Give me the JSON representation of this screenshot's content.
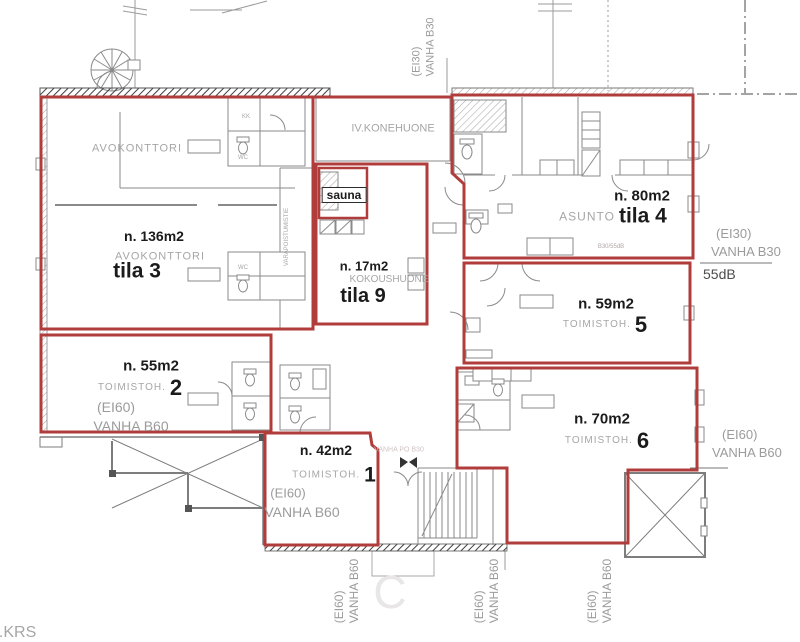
{
  "floor_label": "2.KRS",
  "colors": {
    "compartment_red": "#b13c3c",
    "wall_gray": "#8a8a8a",
    "label_gray": "#a6a6a6",
    "label_dark": "#1b1b1b"
  },
  "rooms": {
    "tila3": {
      "zone_label": "AVOKONTTORI",
      "area": "n. 136m2",
      "type": "AVOKONTTORI",
      "name": "tila 3"
    },
    "tila9": {
      "area": "n. 17m2",
      "type": "KOKOUSHUONE",
      "name": "tila 9"
    },
    "tila4": {
      "area": "n. 80m2",
      "type": "ASUNTO",
      "name": "tila 4",
      "note": "B30/55dB"
    },
    "tila5": {
      "area": "n. 59m2",
      "type": "TOIMISTOH.",
      "number": "5"
    },
    "tila2": {
      "area": "n. 55m2",
      "type": "TOIMISTOH.",
      "number": "2",
      "rating1": "(EI60)",
      "rating2": "VANHA B60"
    },
    "tila1": {
      "area": "n. 42m2",
      "type": "TOIMISTOH.",
      "number": "1",
      "rating1": "(EI60)",
      "rating2": "VANHA B60"
    },
    "tila6": {
      "area": "n. 70m2",
      "type": "TOIMISTOH.",
      "number": "6"
    },
    "sauna": {
      "name": "sauna"
    },
    "iv_room": {
      "name": "IV.KONEHUONE"
    }
  },
  "small_labels": {
    "kk": "KK",
    "wc": "WC",
    "varapoistumistie": "VARAPOISTUMISTIE",
    "vanha_po_b30": "VANHA PO B30",
    "watermark": "C"
  },
  "fire_notes": {
    "top_vertical": {
      "line1": "(EI30)",
      "line2": "VANHA B30"
    },
    "right_upper": {
      "line1": "(EI30)",
      "line2": "VANHA B30",
      "db": "55dB"
    },
    "right_lower": {
      "line1": "(EI60)",
      "line2": "VANHA B60"
    },
    "bottom": [
      {
        "line1": "(EI60)",
        "line2": "VANHA B60"
      },
      {
        "line1": "(EI60)",
        "line2": "VANHA B60"
      },
      {
        "line1": "(EI60)",
        "line2": "VANHA B60"
      }
    ]
  }
}
